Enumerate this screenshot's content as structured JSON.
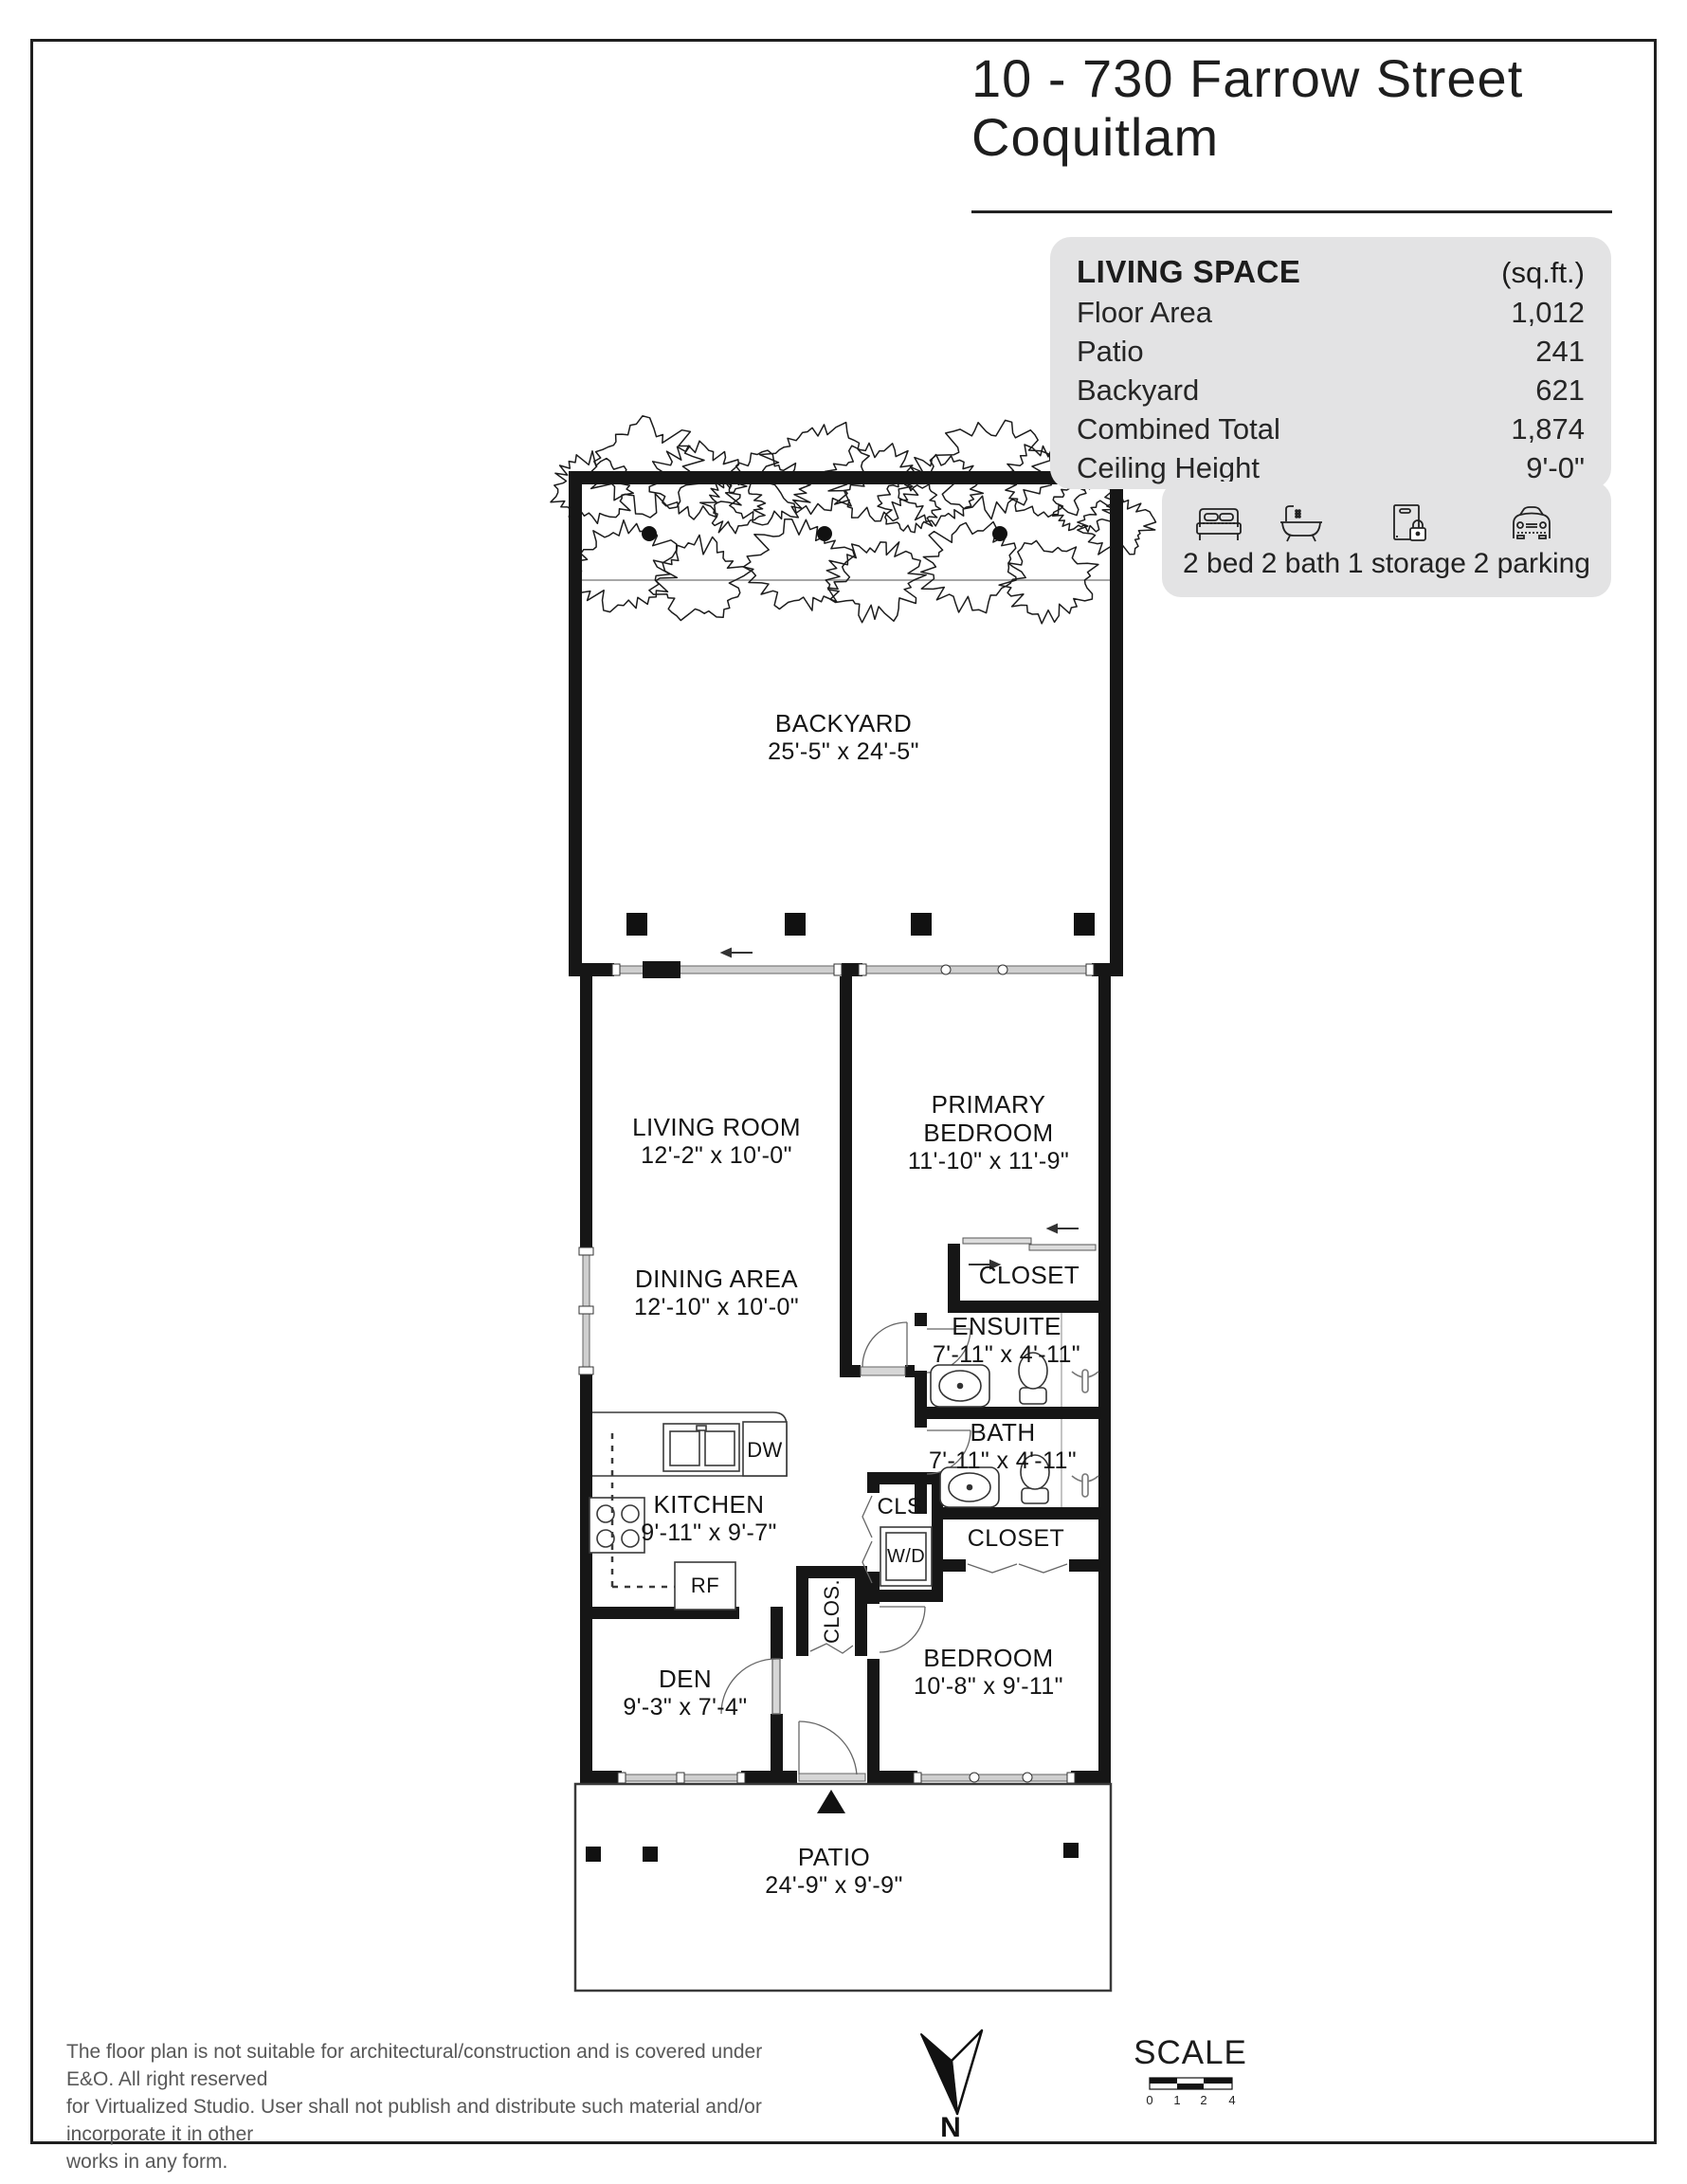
{
  "header": {
    "title_line1": "10 - 730 Farrow Street",
    "title_line2": "Coquitlam"
  },
  "living_space": {
    "title": "LIVING SPACE",
    "unit_label": "(sq.ft.)",
    "bg_color": "#e3e3e4",
    "rows": [
      {
        "label": "Floor Area",
        "value": "1,012"
      },
      {
        "label": "Patio",
        "value": "241"
      },
      {
        "label": "Backyard",
        "value": "621"
      },
      {
        "label": "Combined Total",
        "value": "1,874"
      },
      {
        "label": "Ceiling Height",
        "value": "9'-0\""
      }
    ]
  },
  "features": {
    "items": [
      {
        "icon": "bed-icon",
        "label": "2 bed"
      },
      {
        "icon": "bath-icon",
        "label": "2 bath"
      },
      {
        "icon": "storage-icon",
        "label": "1 storage"
      },
      {
        "icon": "parking-icon",
        "label": "2 parking"
      }
    ]
  },
  "rooms": {
    "backyard": {
      "name": "BACKYARD",
      "dims": "25'-5\" x 24'-5\""
    },
    "living_room": {
      "name": "LIVING ROOM",
      "dims": "12'-2\" x 10'-0\""
    },
    "primary_bedroom": {
      "name_line1": "PRIMARY",
      "name_line2": "BEDROOM",
      "dims": "11'-10\" x 11'-9\""
    },
    "dining_area": {
      "name": "DINING AREA",
      "dims": "12'-10\" x 10'-0\""
    },
    "primary_closet": {
      "name": "CLOSET"
    },
    "ensuite": {
      "name": "ENSUITE",
      "dims": "7'-11\" x 4'-11\""
    },
    "bath": {
      "name": "BATH",
      "dims": "7'-11\" x 4'-11\""
    },
    "kitchen": {
      "name": "KITCHEN",
      "dims": "9'-11\" x 9'-7\""
    },
    "den": {
      "name": "DEN",
      "dims": "9'-3\" x 7'-4\""
    },
    "bedroom": {
      "name": "BEDROOM",
      "dims": "10'-8\" x 9'-11\""
    },
    "bedroom_closet": {
      "name": "CLOSET"
    },
    "laundry": {
      "name": "CLS.",
      "appliance": "W/D"
    },
    "hall_closet": {
      "name": "CLOS."
    },
    "patio": {
      "name": "PATIO",
      "dims": "24'-9\" x 9'-9\""
    },
    "appliances": {
      "dishwasher": "DW",
      "fridge": "RF"
    }
  },
  "footer": {
    "disclaimer_line1": "The floor plan is not suitable for architectural/construction and is covered under E&O. All right reserved",
    "disclaimer_line2": "for Virtualized Studio. User shall not publish and distribute such material and/or incorporate it in other",
    "disclaimer_line3": "works in any form.",
    "north_label": "N",
    "scale_label": "SCALE",
    "scale_ticks": [
      "0",
      "1",
      "2",
      "4"
    ]
  }
}
